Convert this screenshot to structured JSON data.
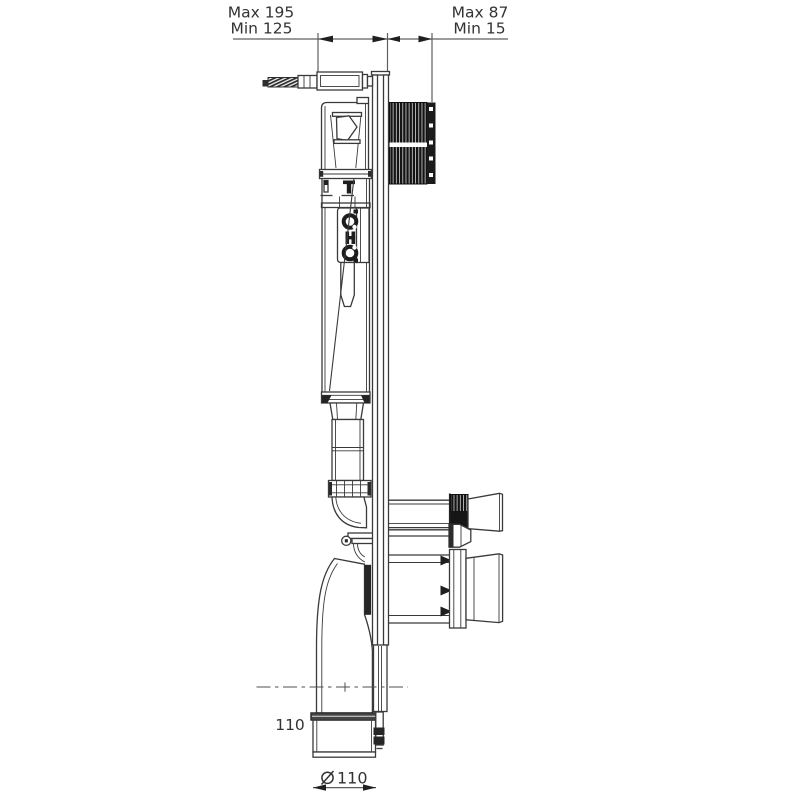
{
  "drawing": {
    "labels": {
      "top_left_max": "Max 195",
      "top_left_min": "Min 125",
      "top_right_max": "Max 87",
      "top_right_min": "Min 15",
      "pipe_offset": "110",
      "diameter_symbol": "⌀",
      "pipe_diameter": "110"
    },
    "colors": {
      "background": "#ffffff",
      "line": "#3a3a3a",
      "dark_fill": "#1b1b1b",
      "dimension_line": "#5f5f5f",
      "text": "#333333"
    }
  }
}
